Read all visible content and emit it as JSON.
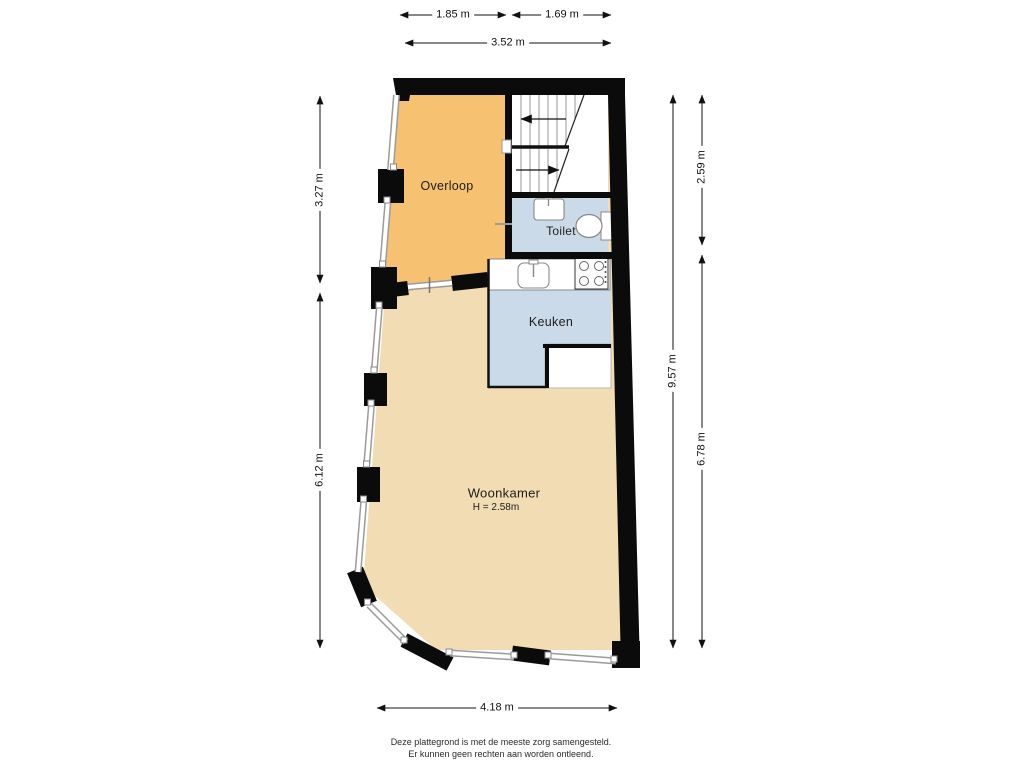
{
  "rooms": {
    "overloop": {
      "label": "Overloop"
    },
    "toilet": {
      "label": "Toilet"
    },
    "keuken": {
      "label": "Keuken"
    },
    "woonkamer": {
      "label": "Woonkamer",
      "height_label": "H = 2.58m"
    }
  },
  "dimensions": {
    "top_left_width": "1.85 m",
    "top_right_width": "1.69 m",
    "top_total_width": "3.52 m",
    "left_upper_height": "3.27 m",
    "left_lower_height": "6.12 m",
    "right_total_height": "9.57 m",
    "right_upper_height": "2.59 m",
    "right_lower_height": "6.78 m",
    "bottom_width": "4.18 m"
  },
  "footer": {
    "line1": "Deze plattegrond is met de meeste zorg samengesteld.",
    "line2": "Er kunnen geen rechten aan worden ontleend."
  },
  "colors": {
    "overloop": "#F6C170",
    "toilet": "#CBDAE9",
    "keuken": "#CBDAE9",
    "woonkamer": "#F2DCB3",
    "wall": "#0b0b0b",
    "window": "#9b9b9b",
    "fixture": "#888888"
  }
}
